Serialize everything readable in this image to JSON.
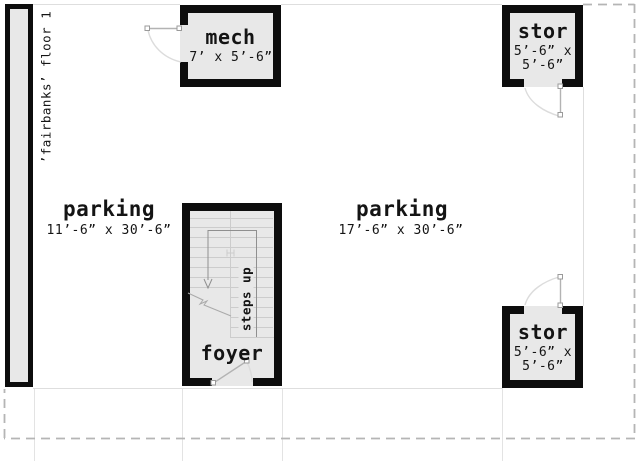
{
  "plan": {
    "title": "’fairbanks’ floor 1",
    "rooms": {
      "mech": {
        "label": "mech",
        "dims": "7’ x 5’-6”"
      },
      "stor_top": {
        "label": "stor",
        "dims_line1": "5’-6” x",
        "dims_line2": "5’-6”"
      },
      "stor_bottom": {
        "label": "stor",
        "dims_line1": "5’-6” x",
        "dims_line2": "5’-6”"
      },
      "foyer": {
        "label": "foyer"
      },
      "parking_left": {
        "label": "parking",
        "dims": "11’-6” x 30’-6”"
      },
      "parking_right": {
        "label": "parking",
        "dims": "17’-6” x 30’-6”"
      }
    },
    "stairs": {
      "label": "steps up"
    }
  },
  "colors": {
    "wall": "#0d0d0d",
    "room_fill": "#e8e8e8",
    "text": "#141414",
    "dash_line": "#b5b5b5",
    "faint_line": "#dedede",
    "ext_line": "#e3e3e3",
    "stair_line": "#cccccc",
    "walk_line": "#8f8f8f",
    "door_line": "#b3b3b3",
    "door_arc": "#dcdcdc"
  }
}
